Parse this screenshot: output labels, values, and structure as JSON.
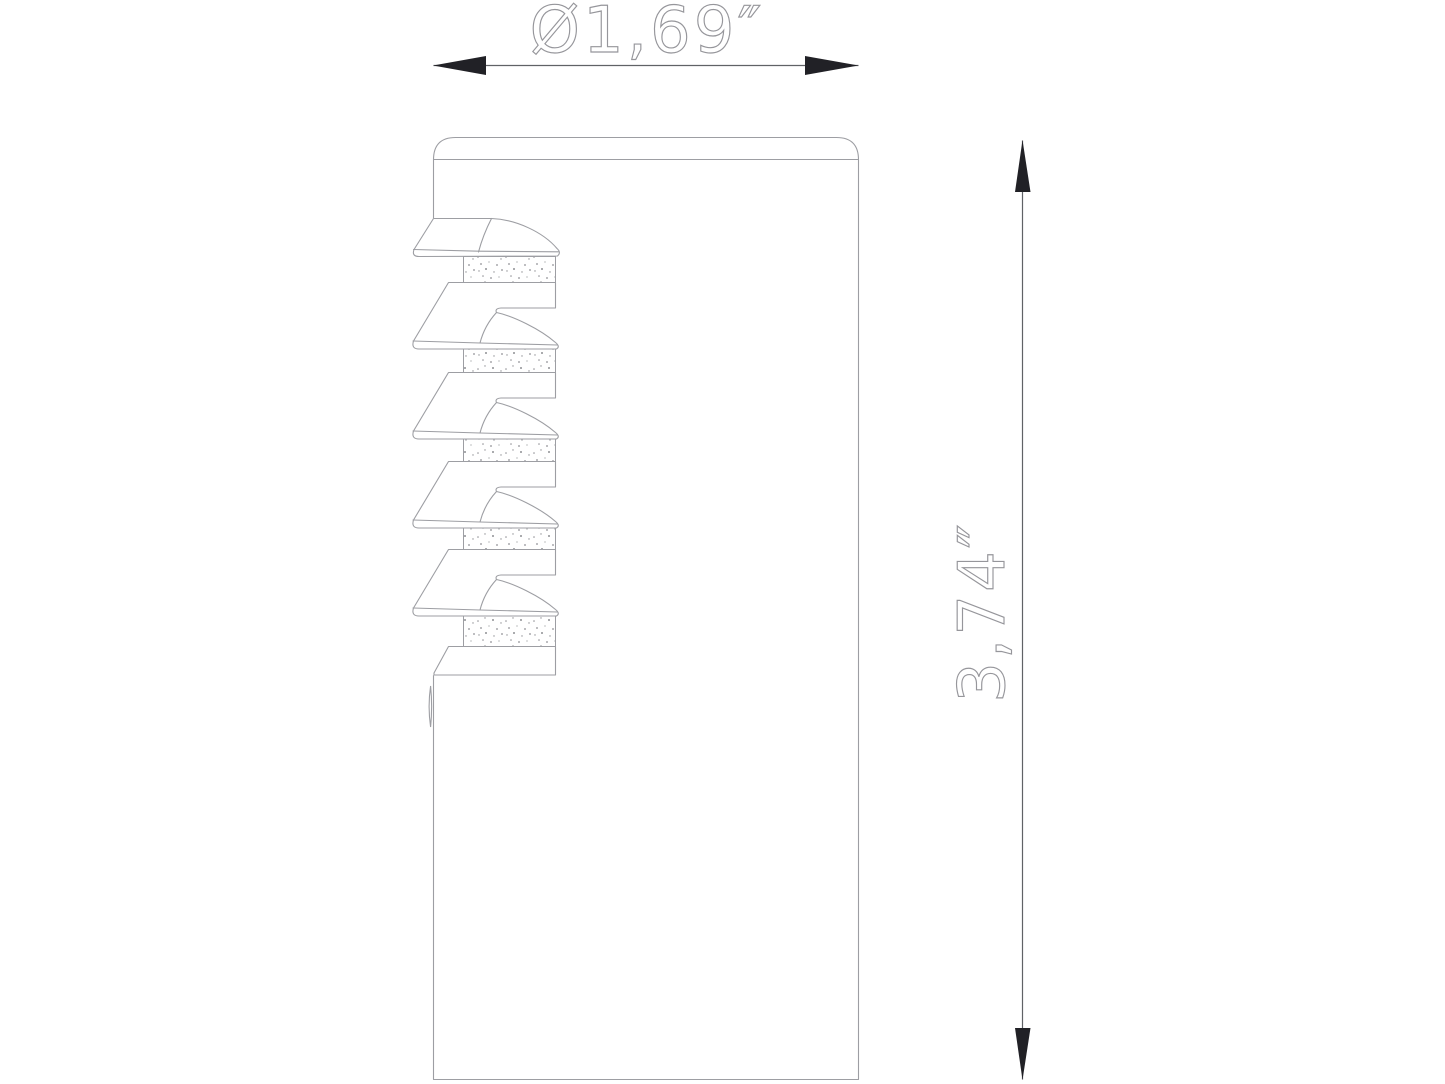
{
  "drawing": {
    "description": "Technical side-view drawing of a cylindrical plug insert with five conical fins, knurled bands and a bottom collar",
    "width_dimension": {
      "label": "Ø1,69″"
    },
    "height_dimension": {
      "label": "3,74″"
    },
    "fin_count": 5,
    "knurl_band_count": 5,
    "colors": {
      "background": "#ffffff",
      "outline": "#9d9ea3",
      "dimension_line": "#606266",
      "arrow": "#212126",
      "text": "#96969b",
      "stipple": "#8f9094"
    }
  }
}
